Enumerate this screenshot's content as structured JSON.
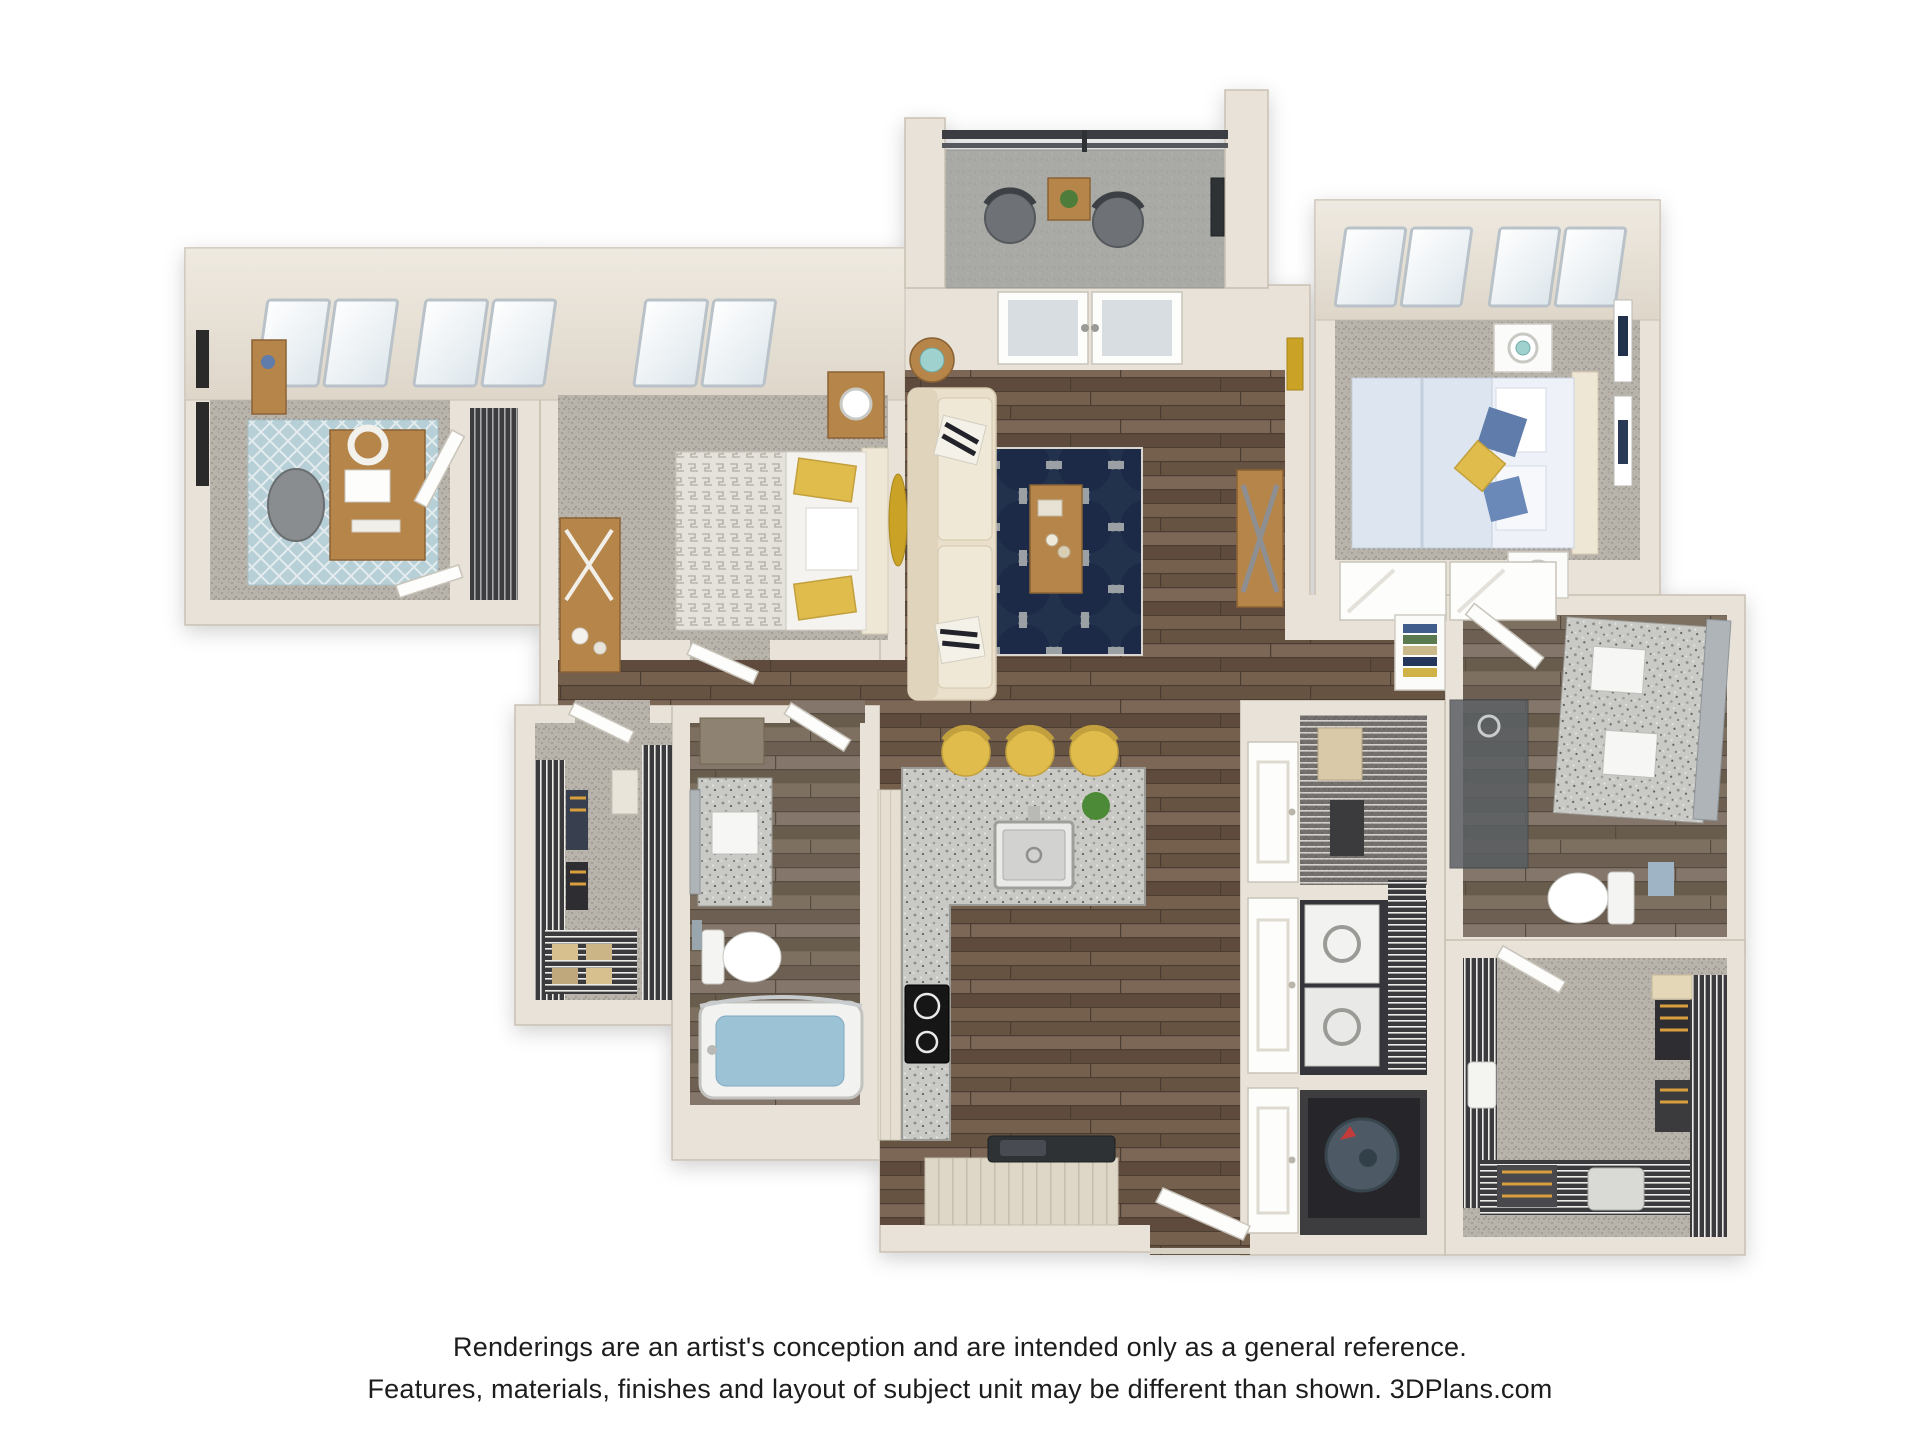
{
  "caption": {
    "line1": "Renderings are an artist's conception and are intended only as a general reference.",
    "line2": "Features, materials, finishes and layout of subject unit may be different than shown. 3DPlans.com"
  },
  "palette": {
    "page-bg": "#ffffff",
    "text": "#1d1d1d",
    "wall": "#e8e2d8",
    "wallEdge": "#c9c0b2",
    "sofa": "#eadfcb",
    "woodFurn": "#b5854a",
    "woodFurnDark": "#8a6234",
    "accentYellow": "#e0bc4e",
    "pillowBlue": "#5f7cab",
    "bedBlue": "#dde6f0",
    "lampTeal": "#9fd2cf",
    "railing": "#3b3e42",
    "glass": "#d7dde0",
    "water": "#9cc2d6",
    "dark": "#2f3136",
    "rugNavy": "#22304e",
    "rugWhite": "#eceae2",
    "carpet": "#b8b3ab",
    "wood": "#6d5847",
    "granite": "#c9c9c5",
    "concrete": "#a9a9a5",
    "artNavy": "#21304e",
    "hanger": "#d99f3e"
  },
  "icons": {
    "plant": "potted-plant-icon",
    "sink": "kitchen-sink-icon",
    "cooktop": "cooktop-icon",
    "toilet": "toilet-icon",
    "tub": "bathtub-icon",
    "washer_dryer": "washer-dryer-icon",
    "water_heater": "water-heater-icon"
  }
}
